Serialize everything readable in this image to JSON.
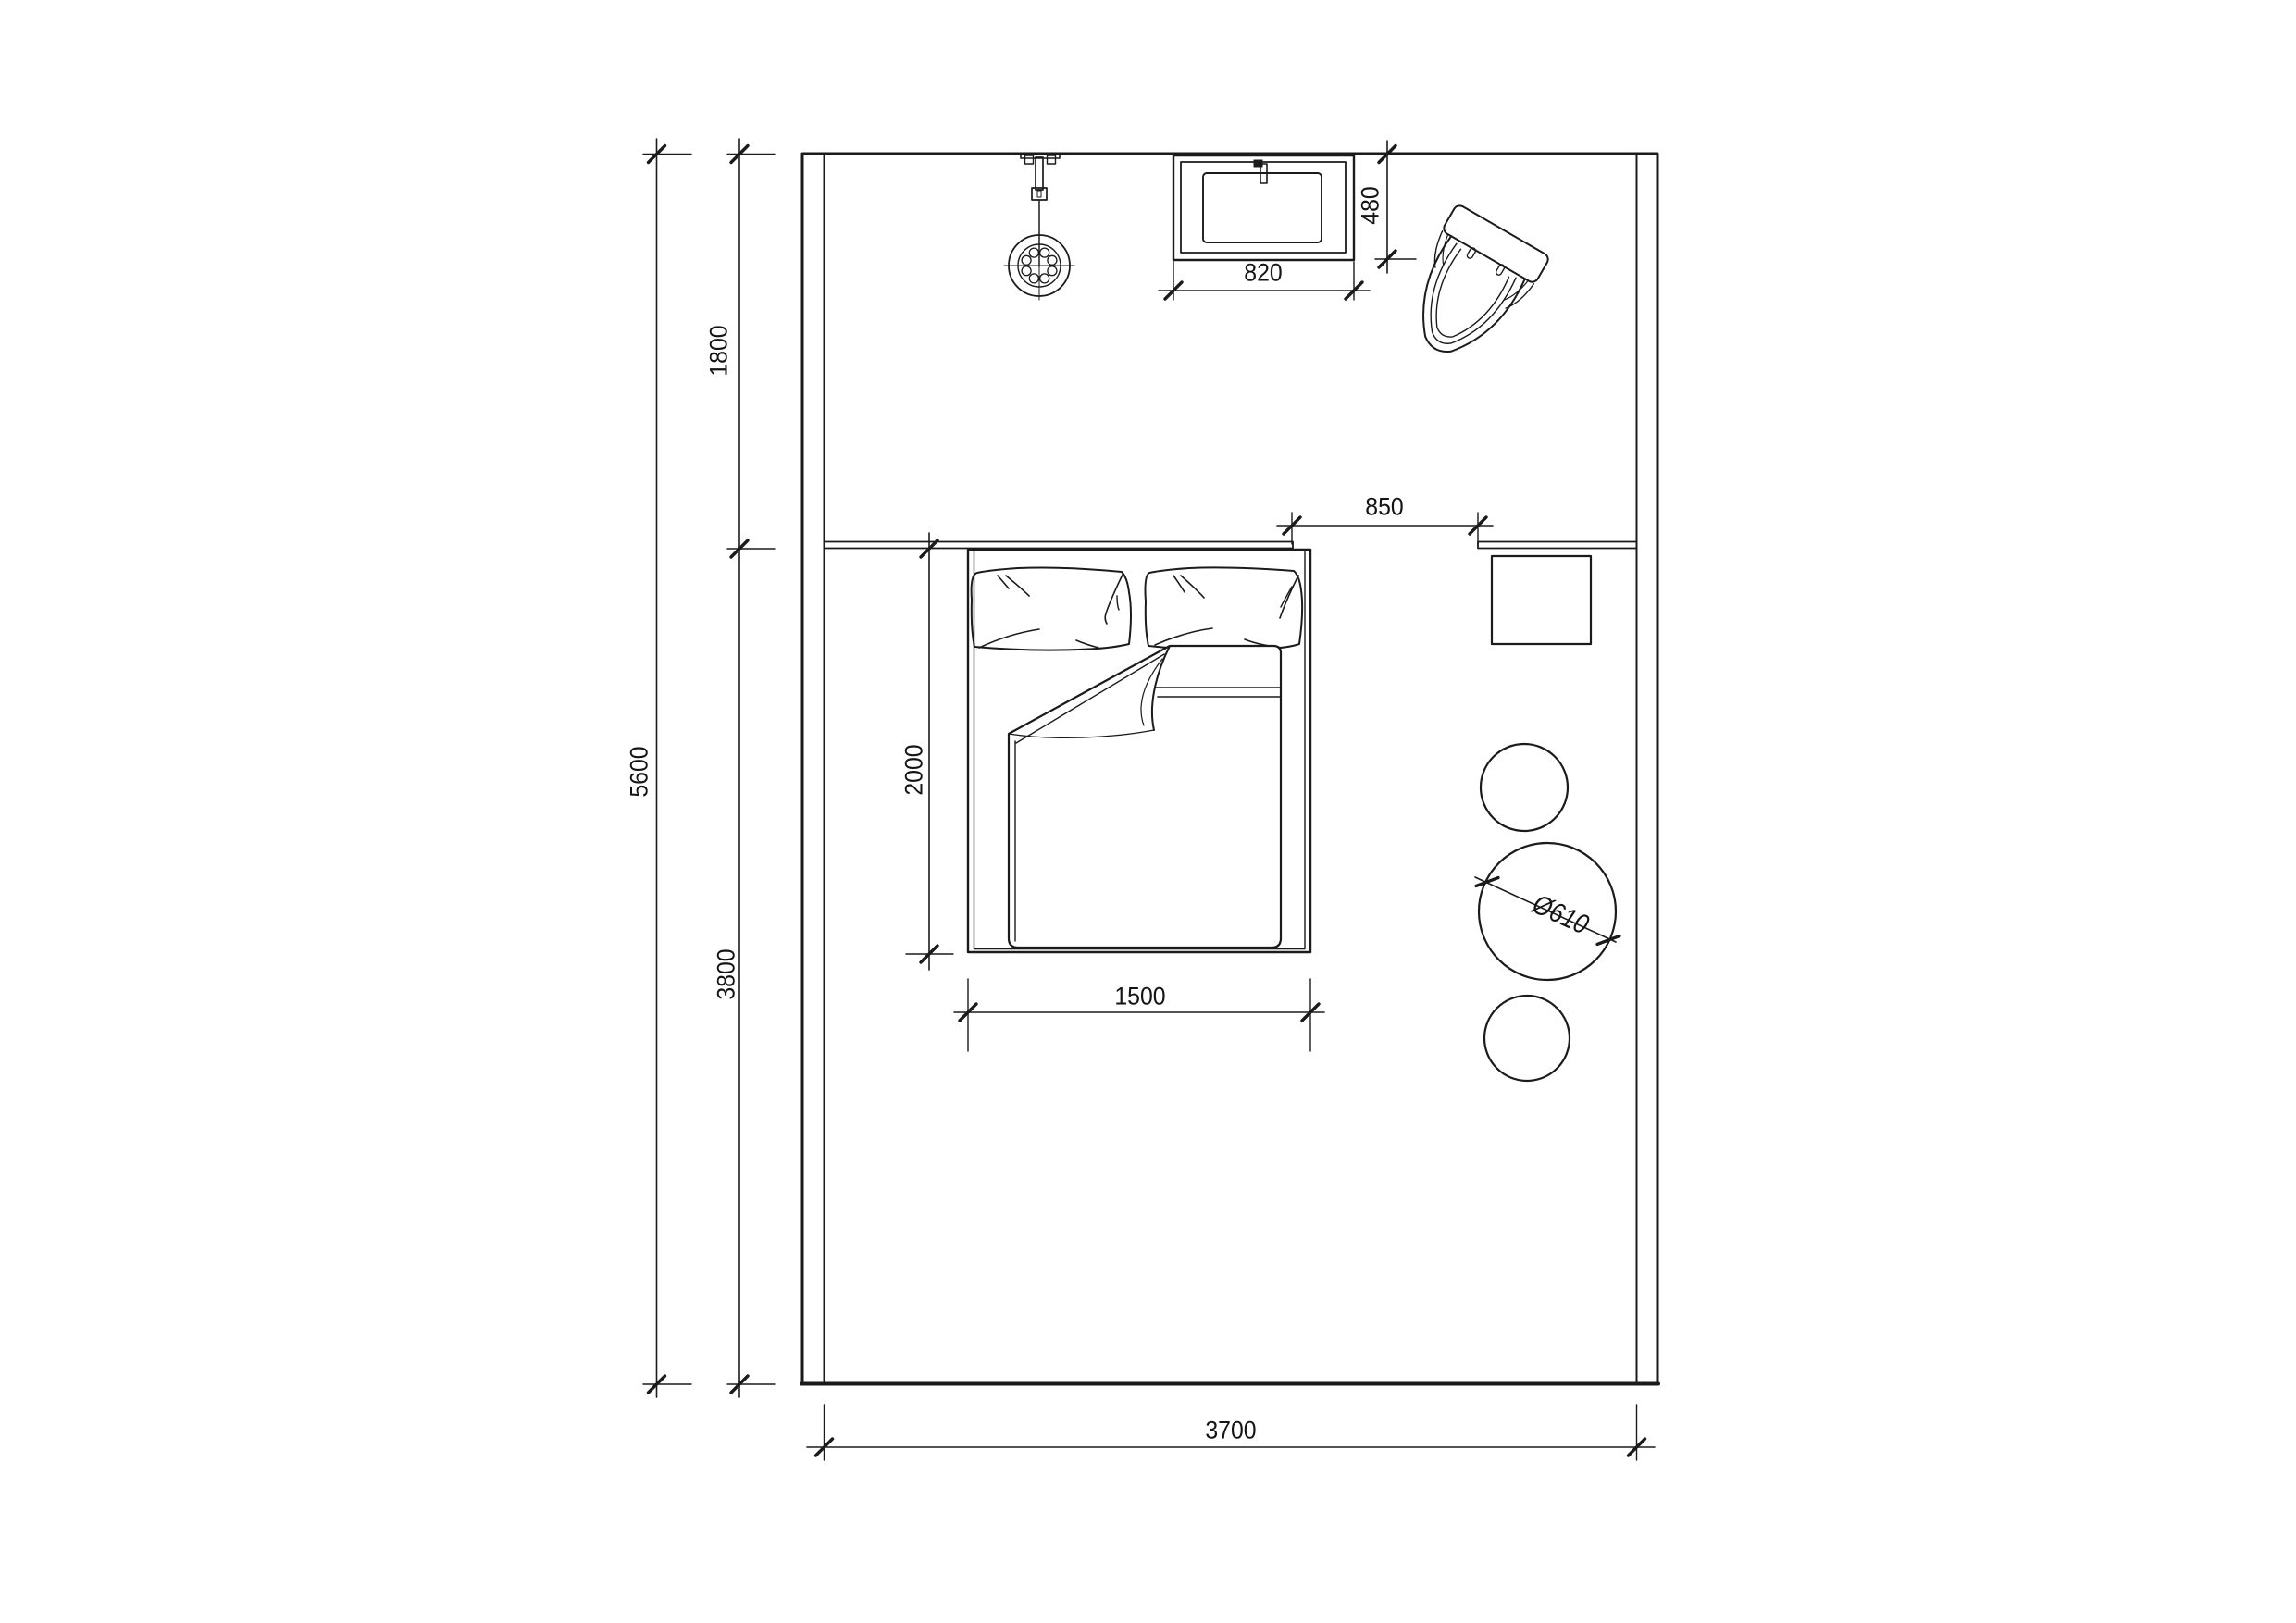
{
  "page": {
    "background": "#ffffff"
  },
  "style": {
    "line_color": "#1b1b1b",
    "text_color": "#141414",
    "wall_fill": "#ffffff"
  },
  "plan": {
    "kind": "bedroom floor plan, top view, black CAD linework on white",
    "units": "mm",
    "objects": [
      "double-bed",
      "pillow-left",
      "pillow-right",
      "folded-duvet",
      "nightstand",
      "round-table",
      "stool-top",
      "stool-bottom",
      "toilet",
      "vanity-basin",
      "faucet",
      "shower-head",
      "partition-wall",
      "room-walls"
    ]
  },
  "dimensions": {
    "room_depth_total": {
      "value": "5600"
    },
    "bath_zone_depth": {
      "value": "1800"
    },
    "bedroom_depth": {
      "value": "3800"
    },
    "room_width": {
      "value": "3700"
    },
    "vanity_width": {
      "value": "820"
    },
    "vanity_depth": {
      "value": "480"
    },
    "passage_opening": {
      "value": "850"
    },
    "bed_length": {
      "value": "2000"
    },
    "bed_width": {
      "value": "1500"
    },
    "table_diameter": {
      "value": "Ø610"
    }
  }
}
